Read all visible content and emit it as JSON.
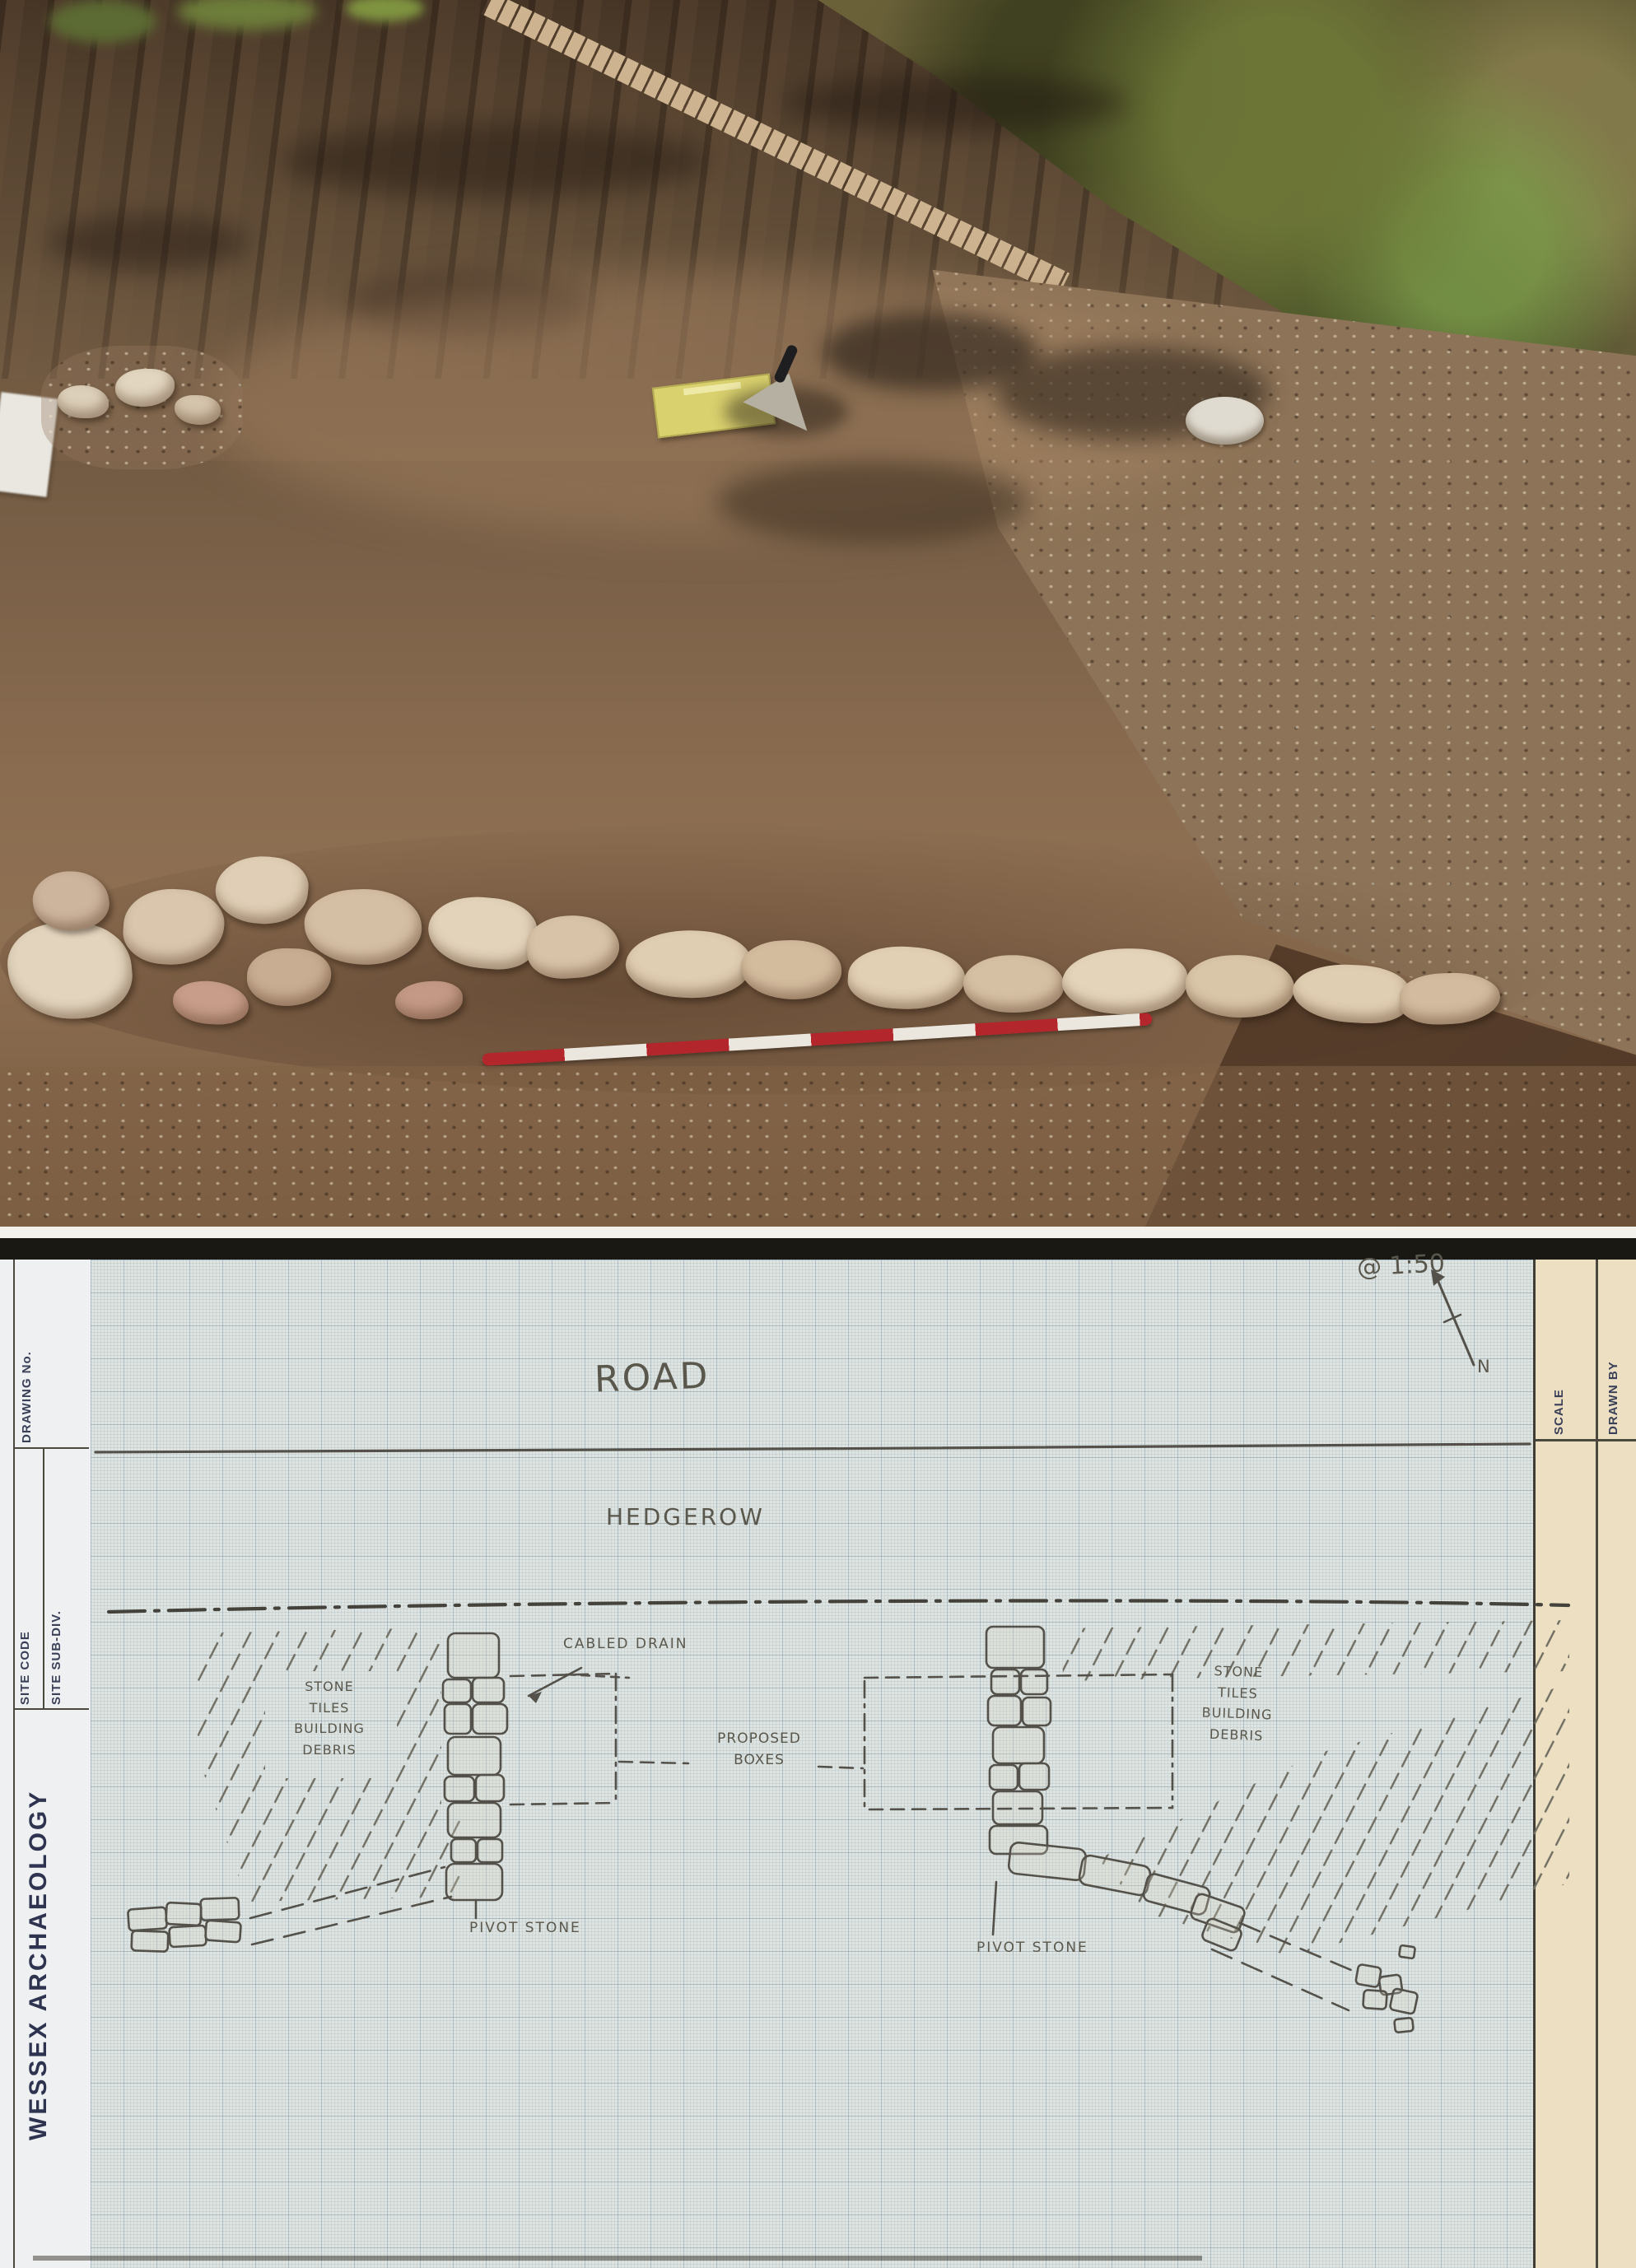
{
  "meta": {
    "title": "Excavation photograph with hand-drawn archaeological site plan"
  },
  "photo": {
    "description": "Stripped-soil excavation trench with an exposed line of light stone wall footing, a red-and-white ranging pole laid along it, a yellow notebook and trowel on the surface, and hedgerow scrub along the right-hand trench edge."
  },
  "plan": {
    "sketch_labels": {
      "road": "ROAD",
      "hedgerow": "HEDGEROW",
      "scale_note": "@ 1:50",
      "north": "N",
      "cabled_drain": "CABLED DRAIN",
      "debris_left": "STONE\nTILES\nBUILDING\nDEBRIS",
      "debris_right": "STONE\nTILES\nBUILDING\nDEBRIS",
      "proposed_boxes": "PROPOSED\nBOXES",
      "pivot_stone_left": "PIVOT STONE",
      "pivot_stone_right": "PIVOT STONE"
    },
    "margin_labels": {
      "drawing_no": "DRAWING No.",
      "site_code": "SITE CODE",
      "site_subdiv": "SITE SUB-DIV.",
      "organisation": "WESSEX ARCHAEOLOGY",
      "scale": "SCALE",
      "drawn_by": "DRAWN BY"
    },
    "colors": {
      "graph_paper": "#dfe4e0",
      "pencil": "#53514a",
      "margin_tan": "#ecdfc2",
      "margin_white": "#eef0f1",
      "print_navy": "#343a56",
      "rod_red": "#b3262c",
      "notebook_yellow": "#d9d06e"
    }
  }
}
